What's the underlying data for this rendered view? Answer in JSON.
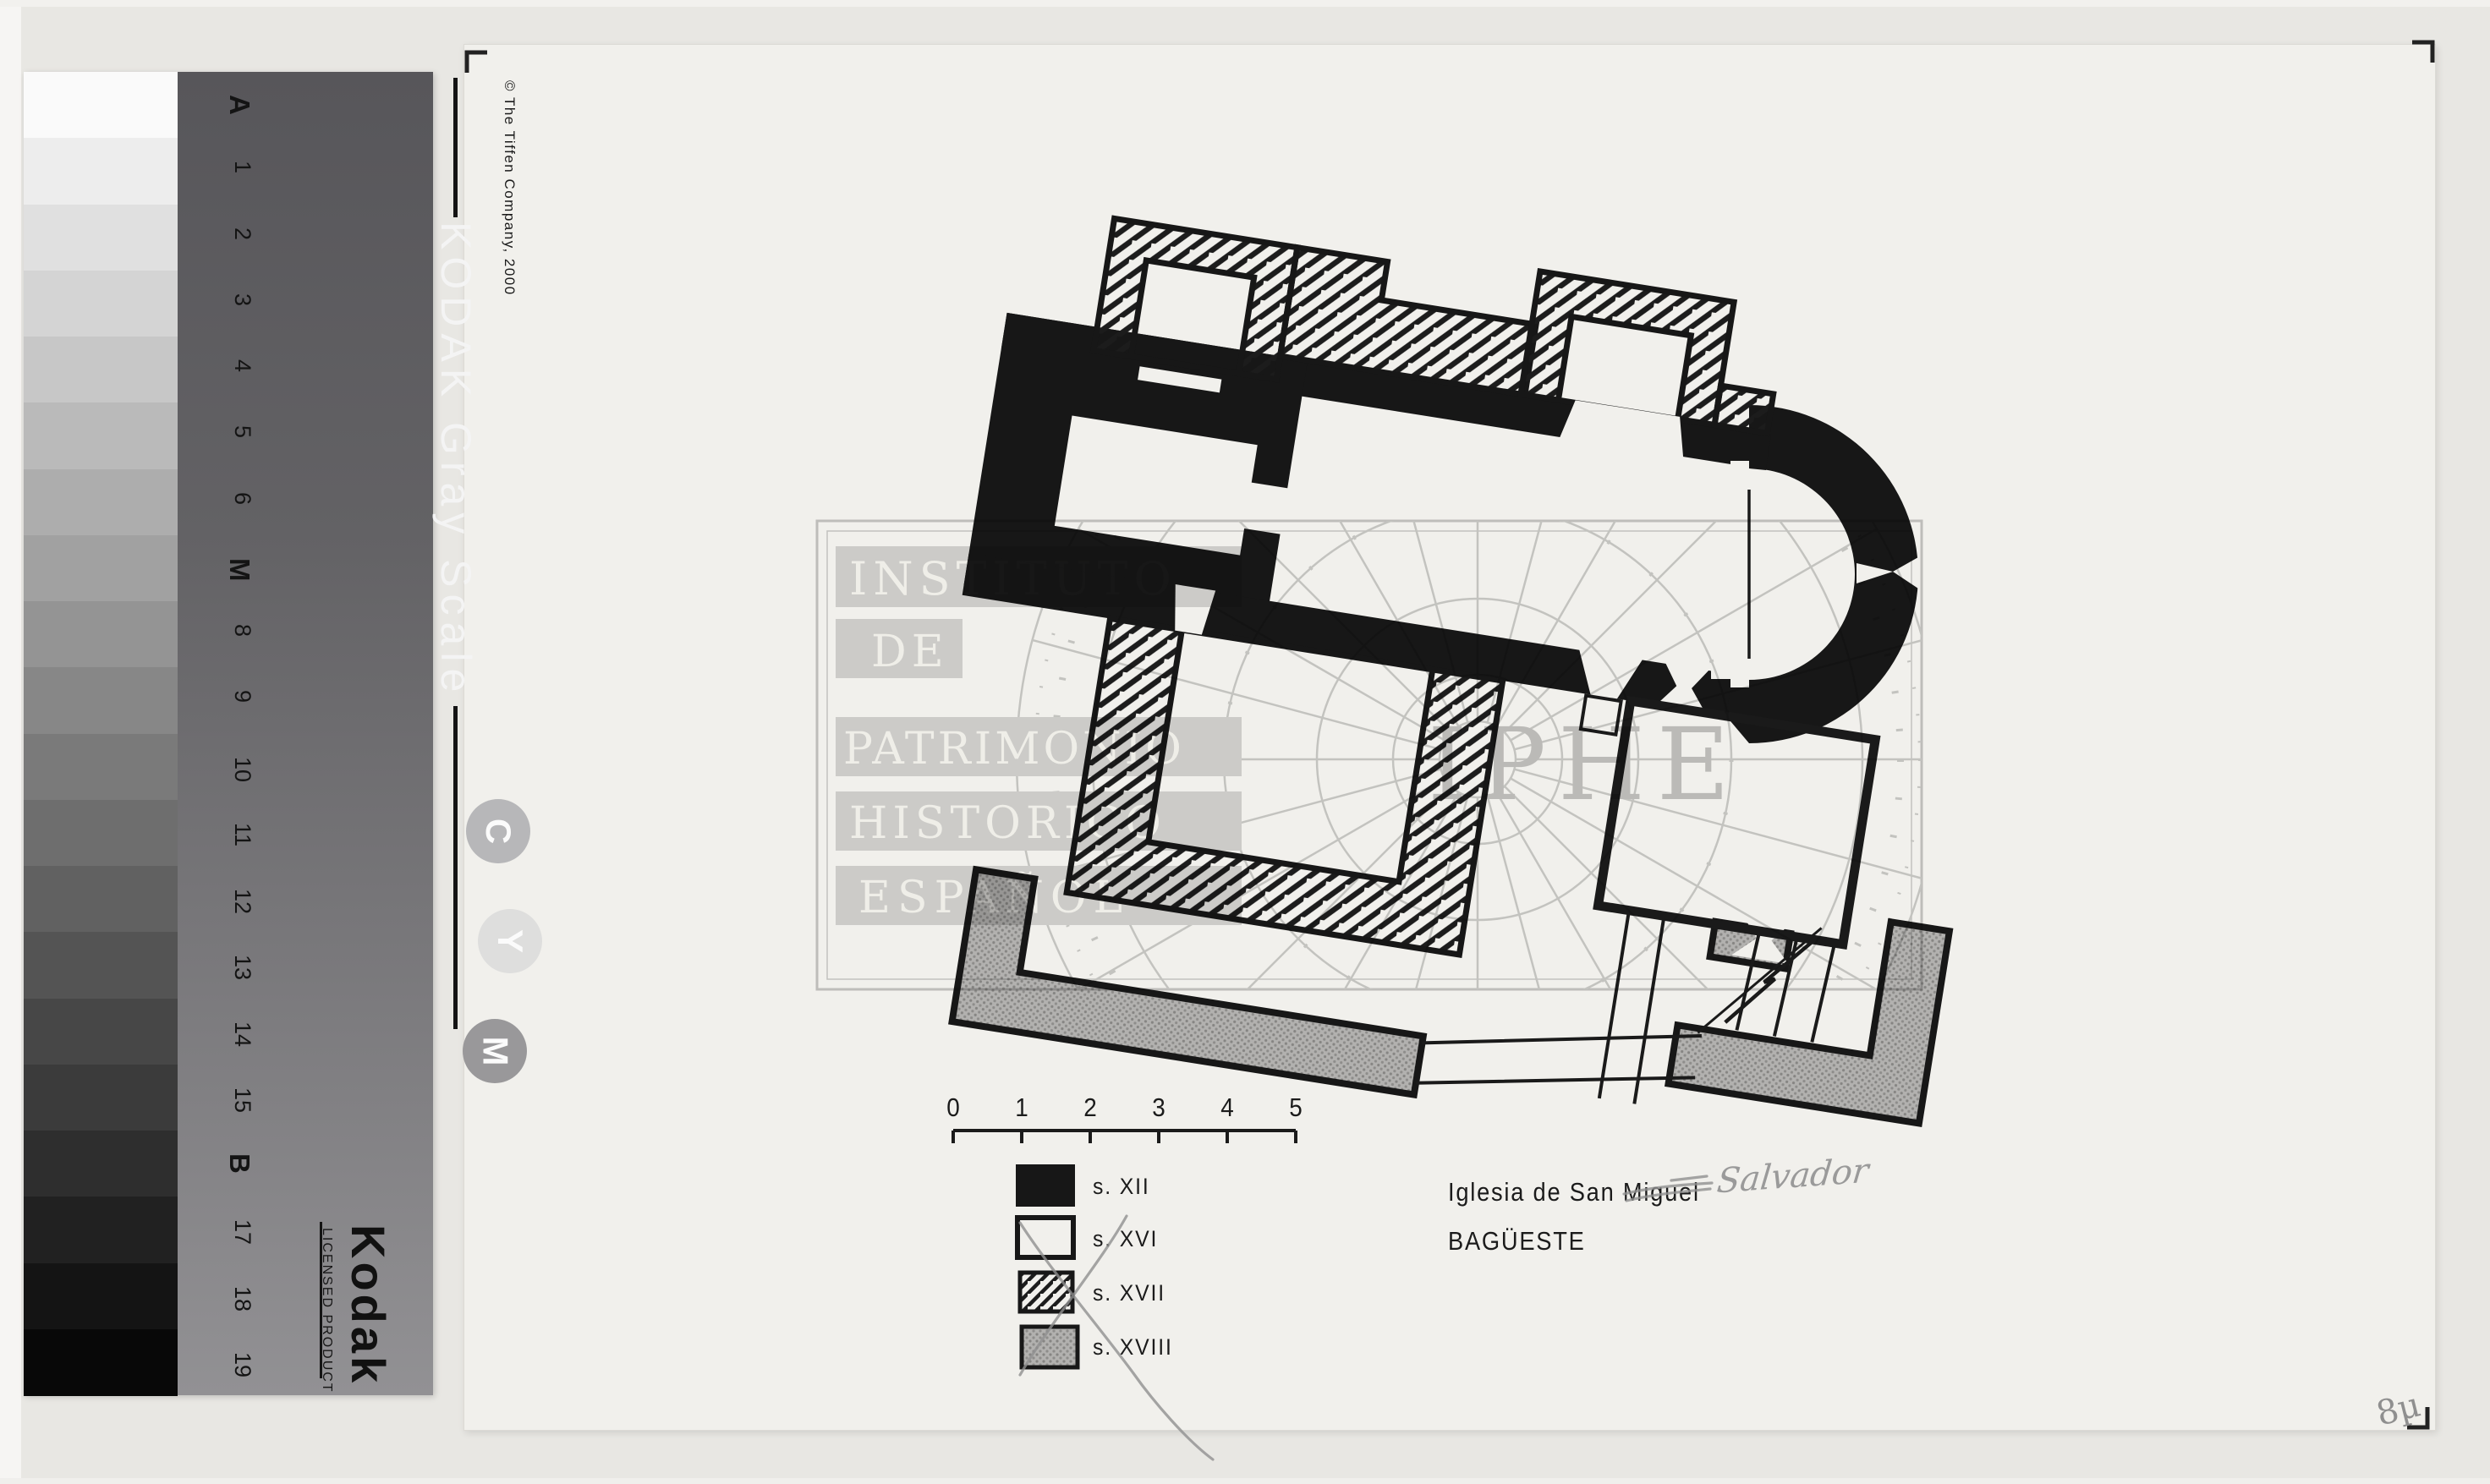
{
  "colors": {
    "background": "#e8e7e3",
    "sheet": "#f1f0ec",
    "ink": "#171717",
    "gray_fill": "#b2b1af",
    "pencil": "#909090",
    "watermark_gray": "#cdcdcd"
  },
  "kodak": {
    "title": "KODAK Gray Scale",
    "copyright": "© The Tiffen Company, 2000",
    "brand": "Kodak",
    "license_line": "LICENSED PRODUCT",
    "step_labels": [
      "A",
      "1",
      "2",
      "3",
      "4",
      "5",
      "6",
      "M",
      "8",
      "9",
      "10",
      "11",
      "12",
      "13",
      "14",
      "15",
      "B",
      "17",
      "18",
      "19"
    ],
    "major_steps": [
      "A",
      "M",
      "B"
    ],
    "ink_circles": [
      "C",
      "Y",
      "M"
    ]
  },
  "plan": {
    "title_line1": "Iglesia de San Miguel",
    "title_line2": "BAGÜESTE",
    "legend": [
      {
        "label": "s. XII",
        "fill": "solid-black"
      },
      {
        "label": "s. XVI",
        "fill": "white-outline"
      },
      {
        "label": "s. XVII",
        "fill": "diagonal-hatch"
      },
      {
        "label": "s. XVIII",
        "fill": "gray-stipple"
      }
    ],
    "scale_bar": {
      "ticks": [
        "0",
        "1",
        "2",
        "3",
        "4",
        "5"
      ]
    }
  },
  "annotations": {
    "crossed_out_word": "Miguel",
    "handwritten_correction": "Salvador",
    "corner_note": "8µ"
  },
  "watermark": {
    "lines": [
      "INSTITUTO",
      "DE",
      "PATRIMONIO",
      "HISTORICO",
      "ESPAÑOL"
    ],
    "acronym": "IPHE"
  }
}
